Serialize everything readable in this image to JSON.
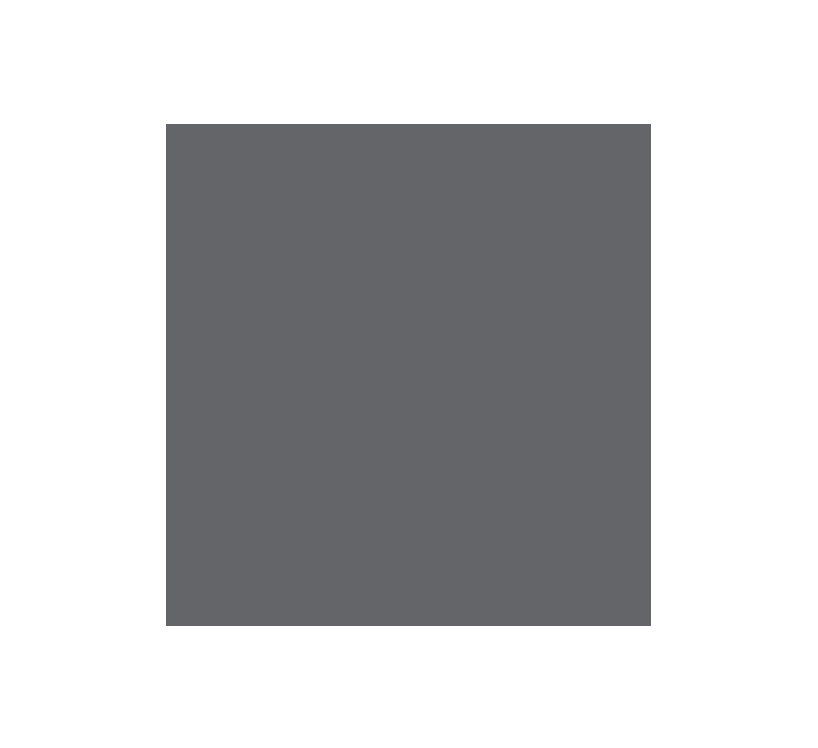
{
  "colors": {
    "page-background": "#ffffff",
    "panel-fill": "#636569"
  },
  "panel": {
    "content": ""
  }
}
